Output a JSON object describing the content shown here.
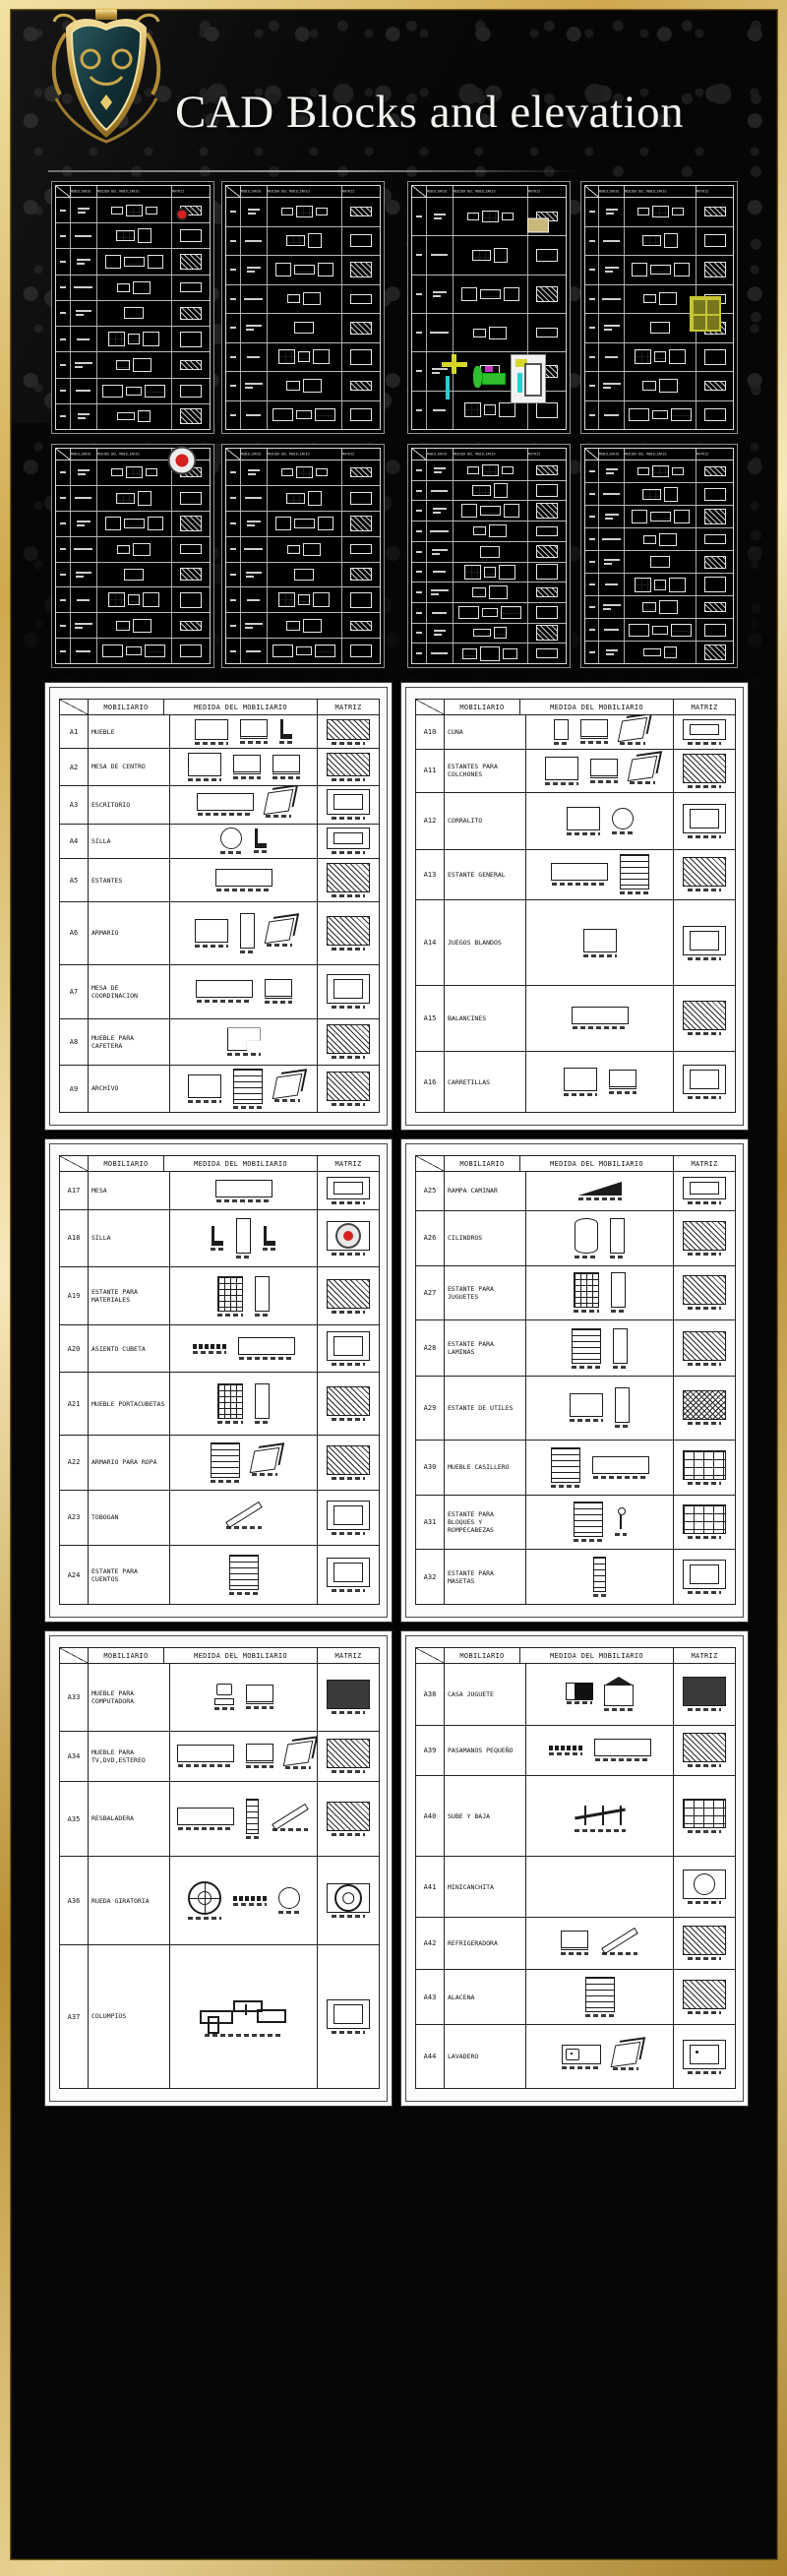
{
  "page": {
    "title": "CAD Blocks and elevation"
  },
  "colors": {
    "gold": "#c9a24b",
    "gold_light": "#f2e3ae",
    "gold_dark": "#8a6a1f",
    "red": "#d42020",
    "tan": "#c9b87a",
    "lime": "#c6c632",
    "green": "#2fbf2f",
    "yellow": "#d6d62a",
    "cyan": "#2ad0d0",
    "magenta": "#c238c2",
    "sheet_line": "#222222",
    "cad_line": "#d8d8d8"
  },
  "table_header": {
    "mobiliario": "MOBILIARIO",
    "medida": "MEDIDA DEL MOBILIARIO",
    "matriz": "MATRIZ"
  },
  "cad_thumbnails": {
    "row1": [
      {
        "rows": 9,
        "accents": [
          {
            "type": "dot",
            "fy": 0.13,
            "where": "matriz",
            "color": "red"
          }
        ]
      },
      {
        "rows": 8,
        "accents": []
      },
      {
        "rows": 6,
        "accents": [
          {
            "type": "tan",
            "fy": 0.17,
            "where": "matriz",
            "color": "tan"
          },
          {
            "type": "playground",
            "fy": 0.78,
            "where": "span"
          }
        ]
      },
      {
        "rows": 8,
        "accents": [
          {
            "type": "window",
            "fy": 0.52,
            "where": "matriz",
            "color": "lime"
          }
        ]
      }
    ],
    "row2": [
      {
        "rows": 8,
        "accents": [
          {
            "type": "target",
            "fy": 0.07,
            "where": "matriz",
            "color": "red"
          }
        ]
      },
      {
        "rows": 8,
        "accents": []
      },
      {
        "rows": 10,
        "accents": []
      },
      {
        "rows": 9,
        "accents": []
      }
    ]
  },
  "sheets": [
    {
      "pos": "band0-left",
      "rows": [
        {
          "id": "A1",
          "label": "MUEBLE",
          "h": 37,
          "sk": [
            "plan",
            "front",
            "chair"
          ],
          "mat": "hatch"
        },
        {
          "id": "A2",
          "label": "MESA DE CENTRO",
          "h": 40,
          "sk": [
            "plan",
            "front",
            "front"
          ],
          "mat": "hatch"
        },
        {
          "id": "A3",
          "label": "ESCRITORIO",
          "h": 42,
          "sk": [
            "wide",
            "iso"
          ],
          "mat": "plain"
        },
        {
          "id": "A4",
          "label": "SILLA",
          "h": 38,
          "sk": [
            "circle",
            "chair"
          ],
          "mat": "plain"
        },
        {
          "id": "A5",
          "label": "ESTANTES",
          "h": 48,
          "sk": [
            "wide"
          ],
          "mat": "hatch"
        },
        {
          "id": "A6",
          "label": "ARMARIO",
          "h": 69,
          "sk": [
            "plan",
            "tall",
            "iso"
          ],
          "mat": "hatch"
        },
        {
          "id": "A7",
          "label": "MESA DE COORDINACION",
          "h": 60,
          "sk": [
            "wide",
            "front"
          ],
          "mat": "plain"
        },
        {
          "id": "A8",
          "label": "MUEBLE PARA CAFETERA",
          "h": 51,
          "sk": [
            "lshape"
          ],
          "mat": "hatch"
        },
        {
          "id": "A9",
          "label": "ARCHIVO",
          "h": 52,
          "sk": [
            "plan",
            "shelf",
            "iso"
          ],
          "mat": "hatch"
        }
      ]
    },
    {
      "pos": "band0-right",
      "rows": [
        {
          "id": "A10",
          "label": "CUNA",
          "h": 37,
          "sk": [
            "tall",
            "front",
            "iso"
          ],
          "mat": "plain"
        },
        {
          "id": "A11",
          "label": "ESTANTES PARA COLCHONES",
          "h": 48,
          "sk": [
            "plan",
            "front",
            "iso"
          ],
          "mat": "hatch"
        },
        {
          "id": "A12",
          "label": "CORRALITO",
          "h": 62,
          "sk": [
            "plan",
            "circle"
          ],
          "mat": "plain"
        },
        {
          "id": "A13",
          "label": "ESTANTE GENERAL",
          "h": 56,
          "sk": [
            "wide",
            "shelf"
          ],
          "mat": "hatch"
        },
        {
          "id": "A14",
          "label": "JUEGOS BLANDOS",
          "h": 94,
          "sk": [
            "plan"
          ],
          "mat": "plain"
        },
        {
          "id": "A15",
          "label": "BALANCINES",
          "h": 73,
          "sk": [
            "wide"
          ],
          "mat": "hatch"
        },
        {
          "id": "A16",
          "label": "CARRETILLAS",
          "h": 67,
          "sk": [
            "plan",
            "front"
          ],
          "mat": "plain"
        }
      ]
    },
    {
      "pos": "band1-left",
      "rows": [
        {
          "id": "A17",
          "label": "MESA",
          "h": 39,
          "sk": [
            "wide"
          ],
          "mat": "plain"
        },
        {
          "id": "A18",
          "label": "SILLA",
          "h": 58,
          "sk": [
            "chair",
            "tall",
            "chair"
          ],
          "mat": "target"
        },
        {
          "id": "A19",
          "label": "ESTANTE PARA MATERIALES",
          "h": 60,
          "sk": [
            "grid",
            "tall"
          ],
          "mat": "hatch"
        },
        {
          "id": "A20",
          "label": "ASIENTO CUBETA",
          "h": 48,
          "sk": [
            "dots",
            "wide"
          ],
          "mat": "plain"
        },
        {
          "id": "A21",
          "label": "MUEBLE PORTACUBETAS",
          "h": 64,
          "sk": [
            "grid",
            "tall"
          ],
          "mat": "hatch"
        },
        {
          "id": "A22",
          "label": "ARMARIO PARA ROPA",
          "h": 56,
          "sk": [
            "shelf",
            "iso"
          ],
          "mat": "hatch"
        },
        {
          "id": "A23",
          "label": "TOBOGAN",
          "h": 57,
          "sk": [
            "slide"
          ],
          "mat": "plain"
        },
        {
          "id": "A24",
          "label": "ESTANTE PARA CUENTOS",
          "h": 60,
          "sk": [
            "shelf"
          ],
          "mat": "plain"
        }
      ]
    },
    {
      "pos": "band1-right",
      "rows": [
        {
          "id": "A25",
          "label": "RAMPA CAMINAR",
          "h": 39,
          "sk": [
            "ramp"
          ],
          "mat": "plain"
        },
        {
          "id": "A26",
          "label": "CILINDROS",
          "h": 55,
          "sk": [
            "cyl",
            "tall"
          ],
          "mat": "hatch"
        },
        {
          "id": "A27",
          "label": "ESTANTE PARA JUGUETES",
          "h": 55,
          "sk": [
            "grid",
            "tall"
          ],
          "mat": "hatch"
        },
        {
          "id": "A28",
          "label": "ESTANTE PARA LAMINAS",
          "h": 56,
          "sk": [
            "shelf",
            "tall"
          ],
          "mat": "hatch"
        },
        {
          "id": "A29",
          "label": "ESTANTE DE UTILES",
          "h": 64,
          "sk": [
            "plan",
            "tall"
          ],
          "mat": "hatch2"
        },
        {
          "id": "A30",
          "label": "MUEBLE CASILLERO",
          "h": 55,
          "sk": [
            "shelf",
            "wide"
          ],
          "mat": "grid"
        },
        {
          "id": "A31",
          "label": "ESTANTE PARA BLOQUES Y ROMPECABEZAS",
          "h": 55,
          "sk": [
            "shelf",
            "person"
          ],
          "mat": "grid"
        },
        {
          "id": "A32",
          "label": "ESTANTE PARA MASETAS",
          "h": 55,
          "sk": [
            "ladder"
          ],
          "mat": "plain"
        }
      ]
    },
    {
      "pos": "band2-left",
      "rows": [
        {
          "id": "A33",
          "label": "MUEBLE PARA COMPUTADORA",
          "h": 70,
          "sk": [
            "pc",
            "front"
          ],
          "mat": "dark"
        },
        {
          "id": "A34",
          "label": "MUEBLE PARA TV,DVD,ESTEREO",
          "h": 52,
          "sk": [
            "wide",
            "front",
            "iso"
          ],
          "mat": "hatch"
        },
        {
          "id": "A35",
          "label": "RESBALADERA",
          "h": 78,
          "sk": [
            "wide",
            "ladder",
            "slide"
          ],
          "mat": "hatch"
        },
        {
          "id": "A36",
          "label": "RUEDA GIRATORIA",
          "h": 92,
          "sk": [
            "wheel",
            "dots",
            "circle"
          ],
          "mat": "wheel"
        },
        {
          "id": "A37",
          "label": "COLUMPIOS",
          "h": 150,
          "sk": [
            "swing"
          ],
          "mat": "plain"
        }
      ]
    },
    {
      "pos": "band2-right",
      "rows": [
        {
          "id": "A38",
          "label": "CASA JUGUETE",
          "h": 63,
          "sk": [
            "solid",
            "house"
          ],
          "mat": "dark"
        },
        {
          "id": "A39",
          "label": "PASAMANOS PEQUEÑO",
          "h": 52,
          "sk": [
            "dots",
            "wide"
          ],
          "mat": "hatch"
        },
        {
          "id": "A40",
          "label": "SUBE Y BAJA",
          "h": 83,
          "sk": [
            "seesaw"
          ],
          "mat": "grid"
        },
        {
          "id": "A41",
          "label": "MINICANCHITA",
          "h": 62,
          "sk": [],
          "mat": "circle"
        },
        {
          "id": "A42",
          "label": "REFRIGERADORA",
          "h": 53,
          "sk": [
            "front",
            "slide"
          ],
          "mat": "hatch"
        },
        {
          "id": "A43",
          "label": "ALACENA",
          "h": 57,
          "sk": [
            "shelf"
          ],
          "mat": "hatch"
        },
        {
          "id": "A44",
          "label": "LAVADERO",
          "h": 65,
          "sk": [
            "sink",
            "iso"
          ],
          "mat": "sink"
        }
      ]
    }
  ]
}
